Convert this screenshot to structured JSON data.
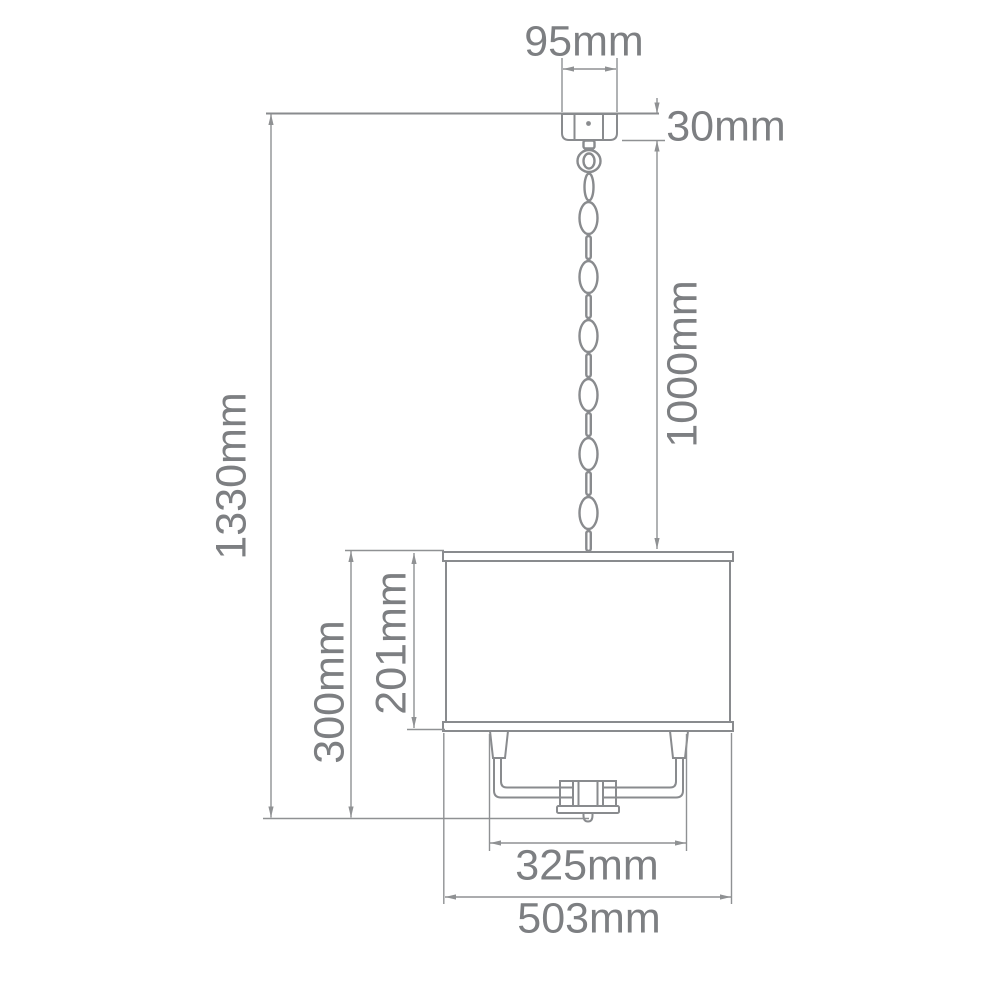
{
  "diagram": {
    "title": "Pendant light fixture dimension drawing",
    "subject": "drum-shade chandelier with ceiling canopy and chain suspension",
    "units": "mm",
    "colors": {
      "background": "#ffffff",
      "object_line": "#898b8e",
      "dimension_line": "#8f9193",
      "text": "#7d7f82"
    },
    "dimensions": {
      "canopy_width": {
        "label": "95mm",
        "value": 95,
        "orientation": "horizontal"
      },
      "canopy_height": {
        "label": "30mm",
        "value": 30,
        "orientation": "horizontal"
      },
      "chain_drop": {
        "label": "1000mm",
        "value": 1000,
        "orientation": "vertical"
      },
      "overall_height": {
        "label": "1330mm",
        "value": 1330,
        "orientation": "vertical"
      },
      "shade_height": {
        "label": "201mm",
        "value": 201,
        "orientation": "vertical"
      },
      "body_height": {
        "label": "300mm",
        "value": 300,
        "orientation": "vertical"
      },
      "frame_width": {
        "label": "325mm",
        "value": 325,
        "orientation": "horizontal"
      },
      "shade_width": {
        "label": "503mm",
        "value": 503,
        "orientation": "horizontal"
      }
    }
  }
}
